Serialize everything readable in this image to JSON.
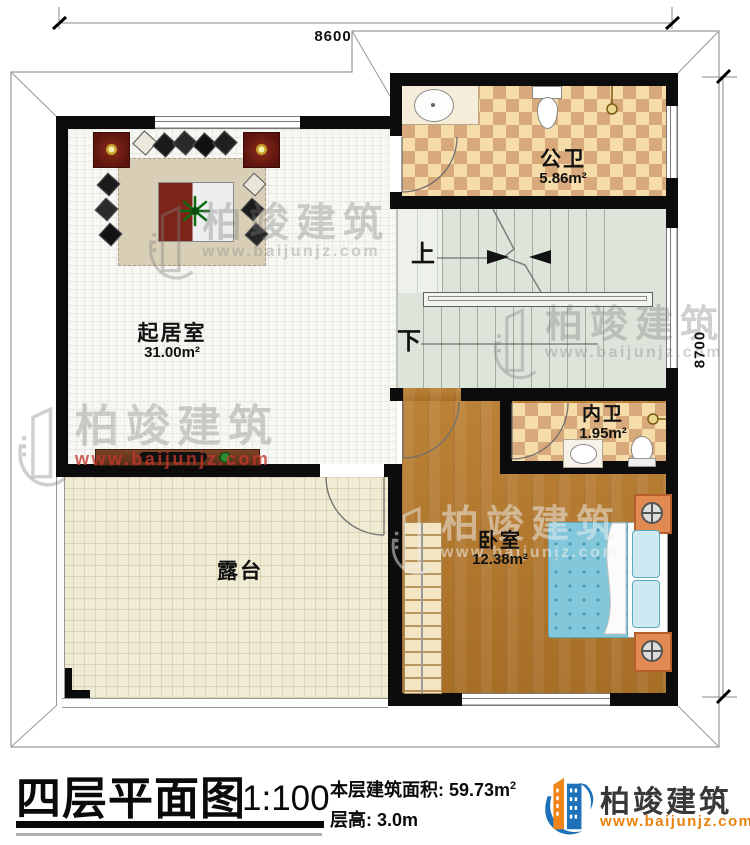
{
  "plan": {
    "dimensions": {
      "width_label": "8600",
      "height_label": "8700"
    },
    "rooms": {
      "living_room": {
        "name": "起居室",
        "area": "31.00m²"
      },
      "public_bathroom": {
        "name": "公卫",
        "area": "5.86m²"
      },
      "inner_bathroom": {
        "name": "内卫",
        "area": "1.95m²"
      },
      "bedroom": {
        "name": "卧室",
        "area": "12.38m²"
      },
      "terrace": {
        "name": "露台"
      }
    },
    "stairs": {
      "up_label": "上",
      "down_label": "下"
    }
  },
  "watermark": {
    "brand": "柏竣建筑",
    "url": "www.baijunjz.com"
  },
  "title_block": {
    "title": "四层平面图",
    "scale": "1:100",
    "floor_area_label": "本层建筑面积: 59.73m",
    "floor_area_sup": "2",
    "floor_height_label": "层高: 3.0m",
    "brand": "柏竣建筑",
    "brand_url": "www.baijunjz.com"
  },
  "colors": {
    "wall": "#0c0c0c",
    "tile_checker_light": "#f6dca9",
    "tile_checker_dark": "#d8a97a",
    "stair_floor": "#dde4da",
    "wood_floor": "#b2792f",
    "terrace_floor": "#f0ecd3",
    "living_floor": "#f7f7f4",
    "bed_blue": "#82c7da",
    "logo_blue": "#1d71b8",
    "logo_orange": "#f08519",
    "url_orange": "#e8820c",
    "watermark_red": "#c3372d"
  }
}
